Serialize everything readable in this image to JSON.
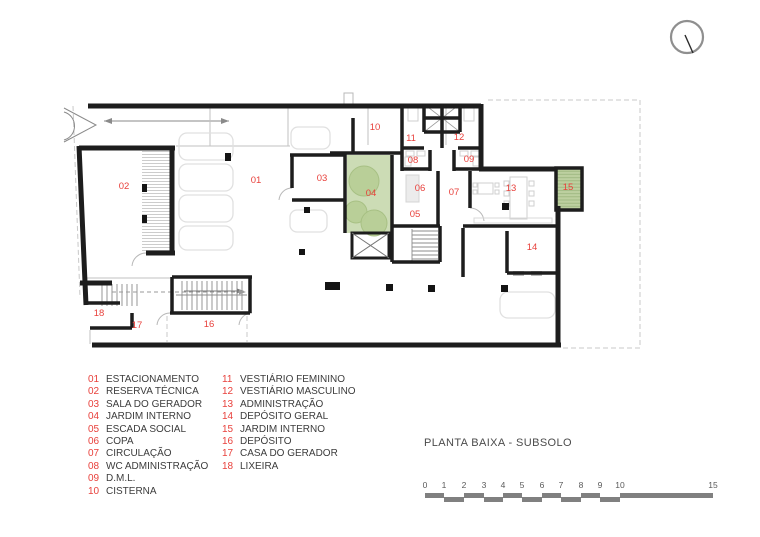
{
  "title": "PLANTA BAIXA - SUBSOLO",
  "legend": {
    "columns": [
      {
        "items": [
          {
            "num": "01",
            "label": "ESTACIONAMENTO"
          },
          {
            "num": "02",
            "label": "RESERVA TÉCNICA"
          },
          {
            "num": "03",
            "label": "SALA DO GERADOR"
          },
          {
            "num": "04",
            "label": "JARDIM INTERNO"
          },
          {
            "num": "05",
            "label": "ESCADA SOCIAL"
          },
          {
            "num": "06",
            "label": "COPA"
          },
          {
            "num": "07",
            "label": "CIRCULAÇÃO"
          },
          {
            "num": "08",
            "label": "WC ADMINISTRAÇÃO"
          },
          {
            "num": "09",
            "label": "D.M.L."
          },
          {
            "num": "10",
            "label": "CISTERNA"
          }
        ]
      },
      {
        "items": [
          {
            "num": "11",
            "label": "VESTIÁRIO FEMININO"
          },
          {
            "num": "12",
            "label": "VESTIÁRIO MASCULINO"
          },
          {
            "num": "13",
            "label": "ADMINISTRAÇÃO"
          },
          {
            "num": "14",
            "label": "DEPÓSITO GERAL"
          },
          {
            "num": "15",
            "label": "JARDIM INTERNO"
          },
          {
            "num": "16",
            "label": "DEPÓSITO"
          },
          {
            "num": "17",
            "label": "CASA DO GERADOR"
          },
          {
            "num": "18",
            "label": "LIXEIRA"
          }
        ]
      }
    ]
  },
  "scale_bar": {
    "ticks": [
      {
        "label": "0",
        "x": 1
      },
      {
        "label": "1",
        "x": 20
      },
      {
        "label": "2",
        "x": 40
      },
      {
        "label": "3",
        "x": 60
      },
      {
        "label": "4",
        "x": 79
      },
      {
        "label": "5",
        "x": 98
      },
      {
        "label": "6",
        "x": 118
      },
      {
        "label": "7",
        "x": 137
      },
      {
        "label": "8",
        "x": 157
      },
      {
        "label": "9",
        "x": 176
      },
      {
        "label": "10",
        "x": 196
      },
      {
        "label": "15",
        "x": 289
      }
    ],
    "bars": [
      {
        "x": 1,
        "w": 19,
        "row": 0
      },
      {
        "x": 20,
        "w": 20,
        "row": 1
      },
      {
        "x": 40,
        "w": 20,
        "row": 0
      },
      {
        "x": 60,
        "w": 19,
        "row": 1
      },
      {
        "x": 79,
        "w": 19,
        "row": 0
      },
      {
        "x": 98,
        "w": 20,
        "row": 1
      },
      {
        "x": 118,
        "w": 19,
        "row": 0
      },
      {
        "x": 137,
        "w": 20,
        "row": 1
      },
      {
        "x": 157,
        "w": 19,
        "row": 0
      },
      {
        "x": 176,
        "w": 20,
        "row": 1
      },
      {
        "x": 196,
        "w": 93,
        "row": 0
      }
    ]
  },
  "plan": {
    "room_labels": [
      {
        "num": "01",
        "x": 256,
        "y": 183
      },
      {
        "num": "02",
        "x": 124,
        "y": 189
      },
      {
        "num": "03",
        "x": 322,
        "y": 181
      },
      {
        "num": "04",
        "x": 371,
        "y": 196
      },
      {
        "num": "05",
        "x": 415,
        "y": 217
      },
      {
        "num": "06",
        "x": 420,
        "y": 191
      },
      {
        "num": "07",
        "x": 454,
        "y": 195
      },
      {
        "num": "08",
        "x": 413,
        "y": 163
      },
      {
        "num": "09",
        "x": 469,
        "y": 162
      },
      {
        "num": "10",
        "x": 375,
        "y": 130
      },
      {
        "num": "11",
        "x": 411,
        "y": 141
      },
      {
        "num": "12",
        "x": 459,
        "y": 140
      },
      {
        "num": "13",
        "x": 511,
        "y": 191
      },
      {
        "num": "14",
        "x": 532,
        "y": 250
      },
      {
        "num": "15",
        "x": 568,
        "y": 190
      },
      {
        "num": "16",
        "x": 209,
        "y": 327
      },
      {
        "num": "17",
        "x": 137,
        "y": 328
      },
      {
        "num": "18",
        "x": 99,
        "y": 316
      }
    ],
    "colors": {
      "wall": "#1d1d1d",
      "room_label": "#e8413c",
      "garden_fill": "#ccdcb5",
      "garden_tree": "#b9cf97",
      "scale_bar": "#808080",
      "dashed_boundary": "#c8c8c8"
    }
  }
}
